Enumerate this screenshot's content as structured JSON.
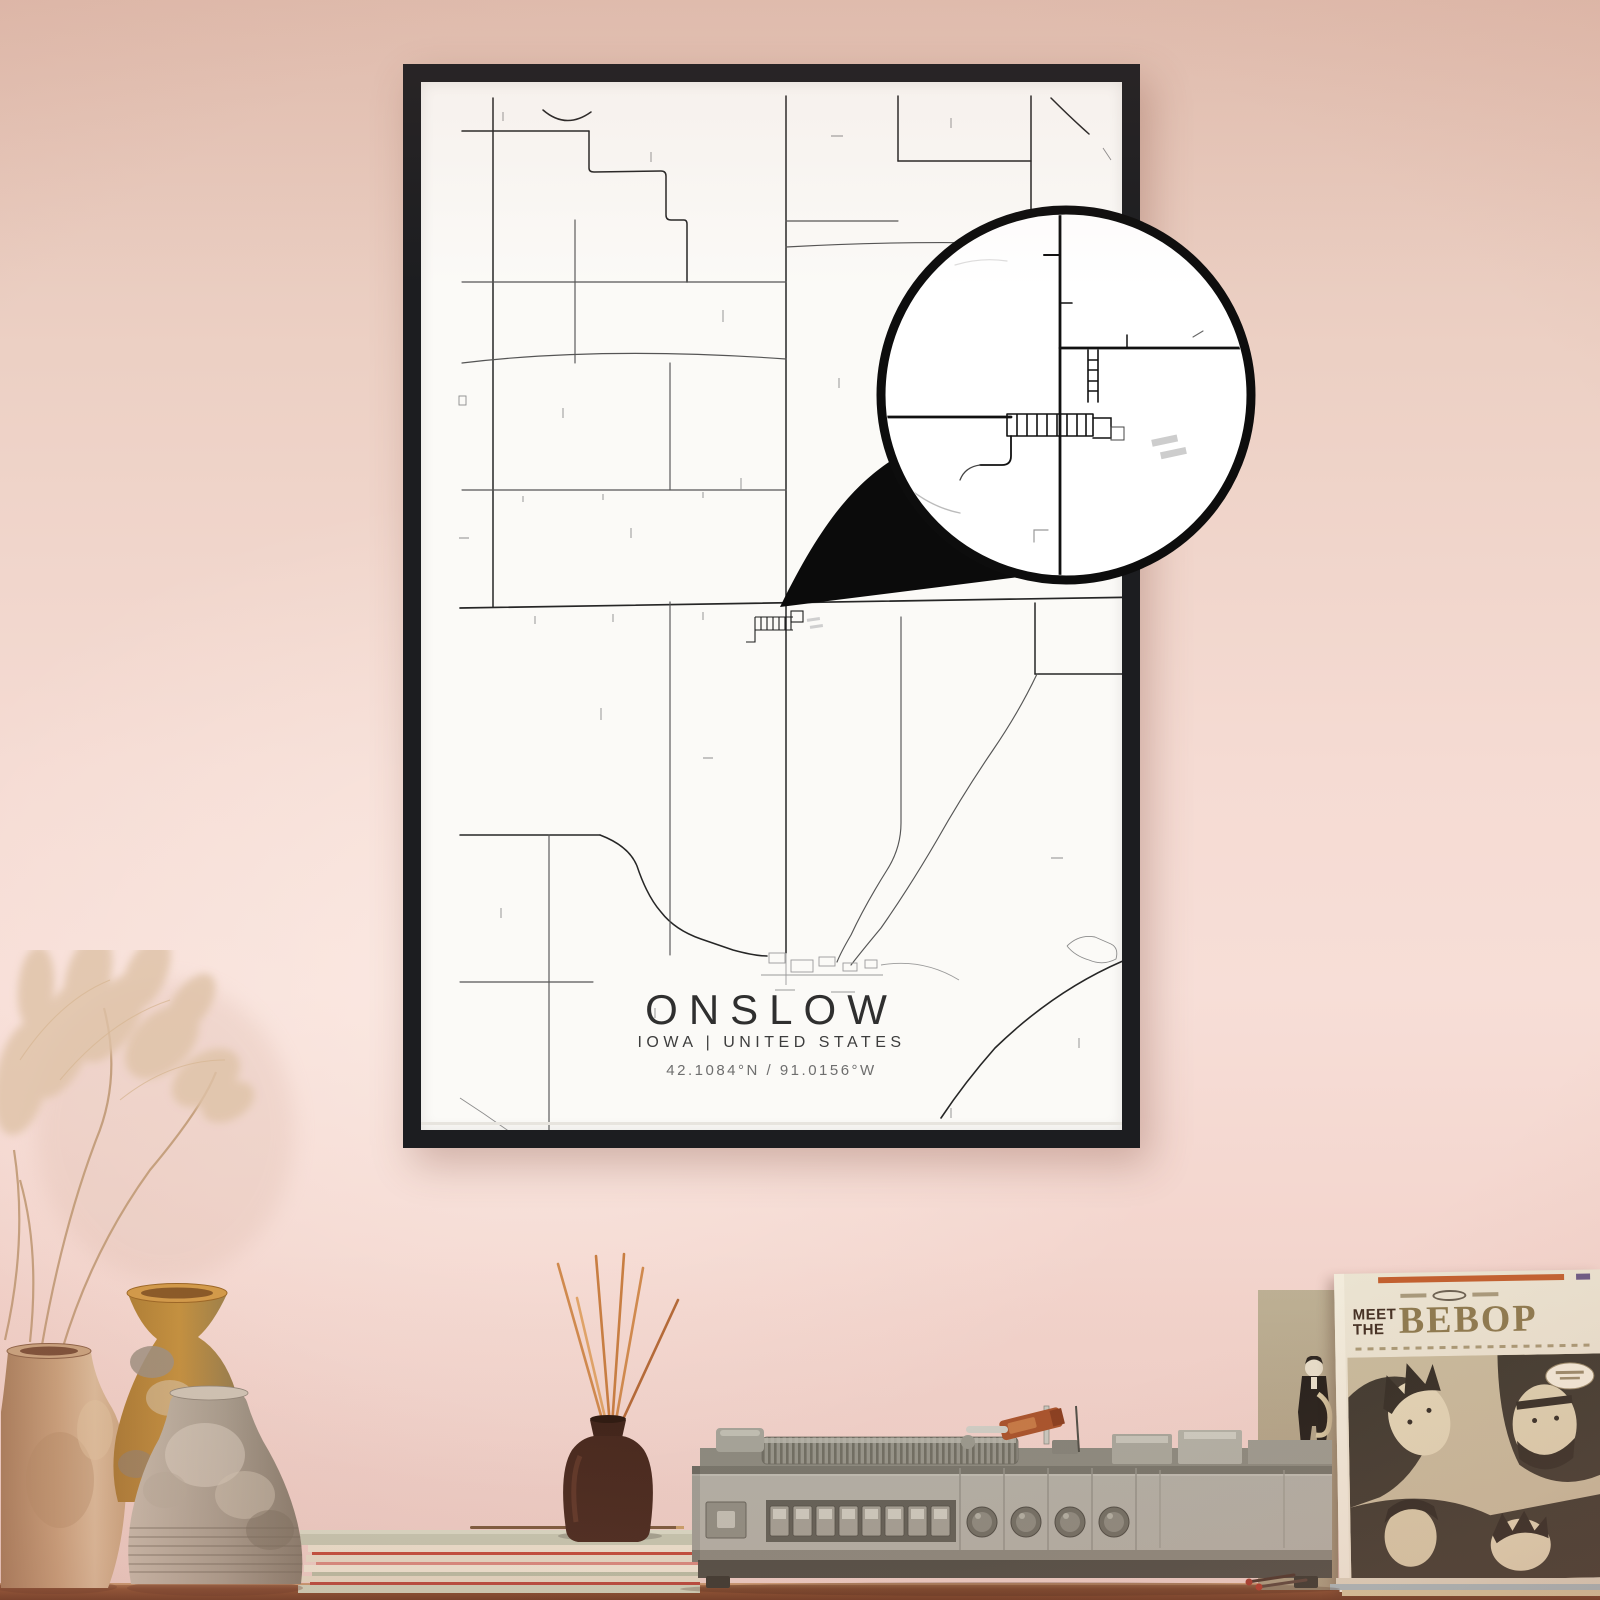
{
  "scene": {
    "wall_top_color": "#e3c2b4",
    "wall_mid_color": "#f6dcd5",
    "wall_bottom_color": "#eecfc8",
    "table_color": "#8a4f30"
  },
  "poster": {
    "title": "ONSLOW",
    "subtitle": "IOWA | UNITED STATES",
    "coordinates": "42.1084°N / 91.0156°W",
    "frame_color": "#1c1d20",
    "paper_color": "#fbfaf7",
    "road_color": "#262626"
  },
  "magnifier": {
    "fill_color": "#ffffff",
    "border_color": "#0d0d0d"
  },
  "record_sleeve": {
    "meet_label": "MEET",
    "the_label": "THE",
    "title": "BEBOP"
  }
}
